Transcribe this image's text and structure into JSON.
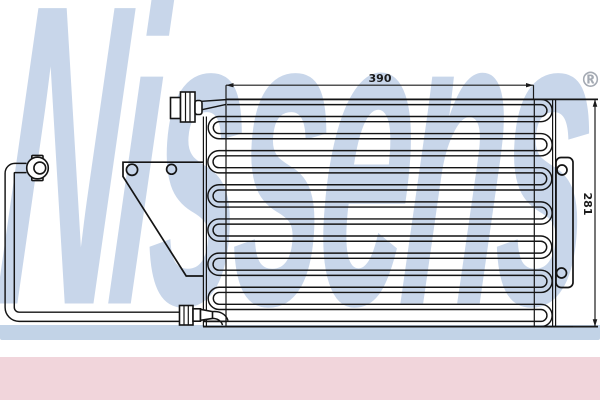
{
  "watermark": {
    "text": "Nissens",
    "registered_mark": "®"
  },
  "dimensions": {
    "width_label": "390",
    "height_label": "281"
  },
  "colors": {
    "watermark_blue": "#c8d6ea",
    "swoosh_blue": "#c2d3e7",
    "bottom_bar_pink": "#f1d5db",
    "line_color": "#141414",
    "reg_mark_gray": "#9ba1ab",
    "dim_text": "#1b1b1b",
    "bg": "#ffffff"
  }
}
